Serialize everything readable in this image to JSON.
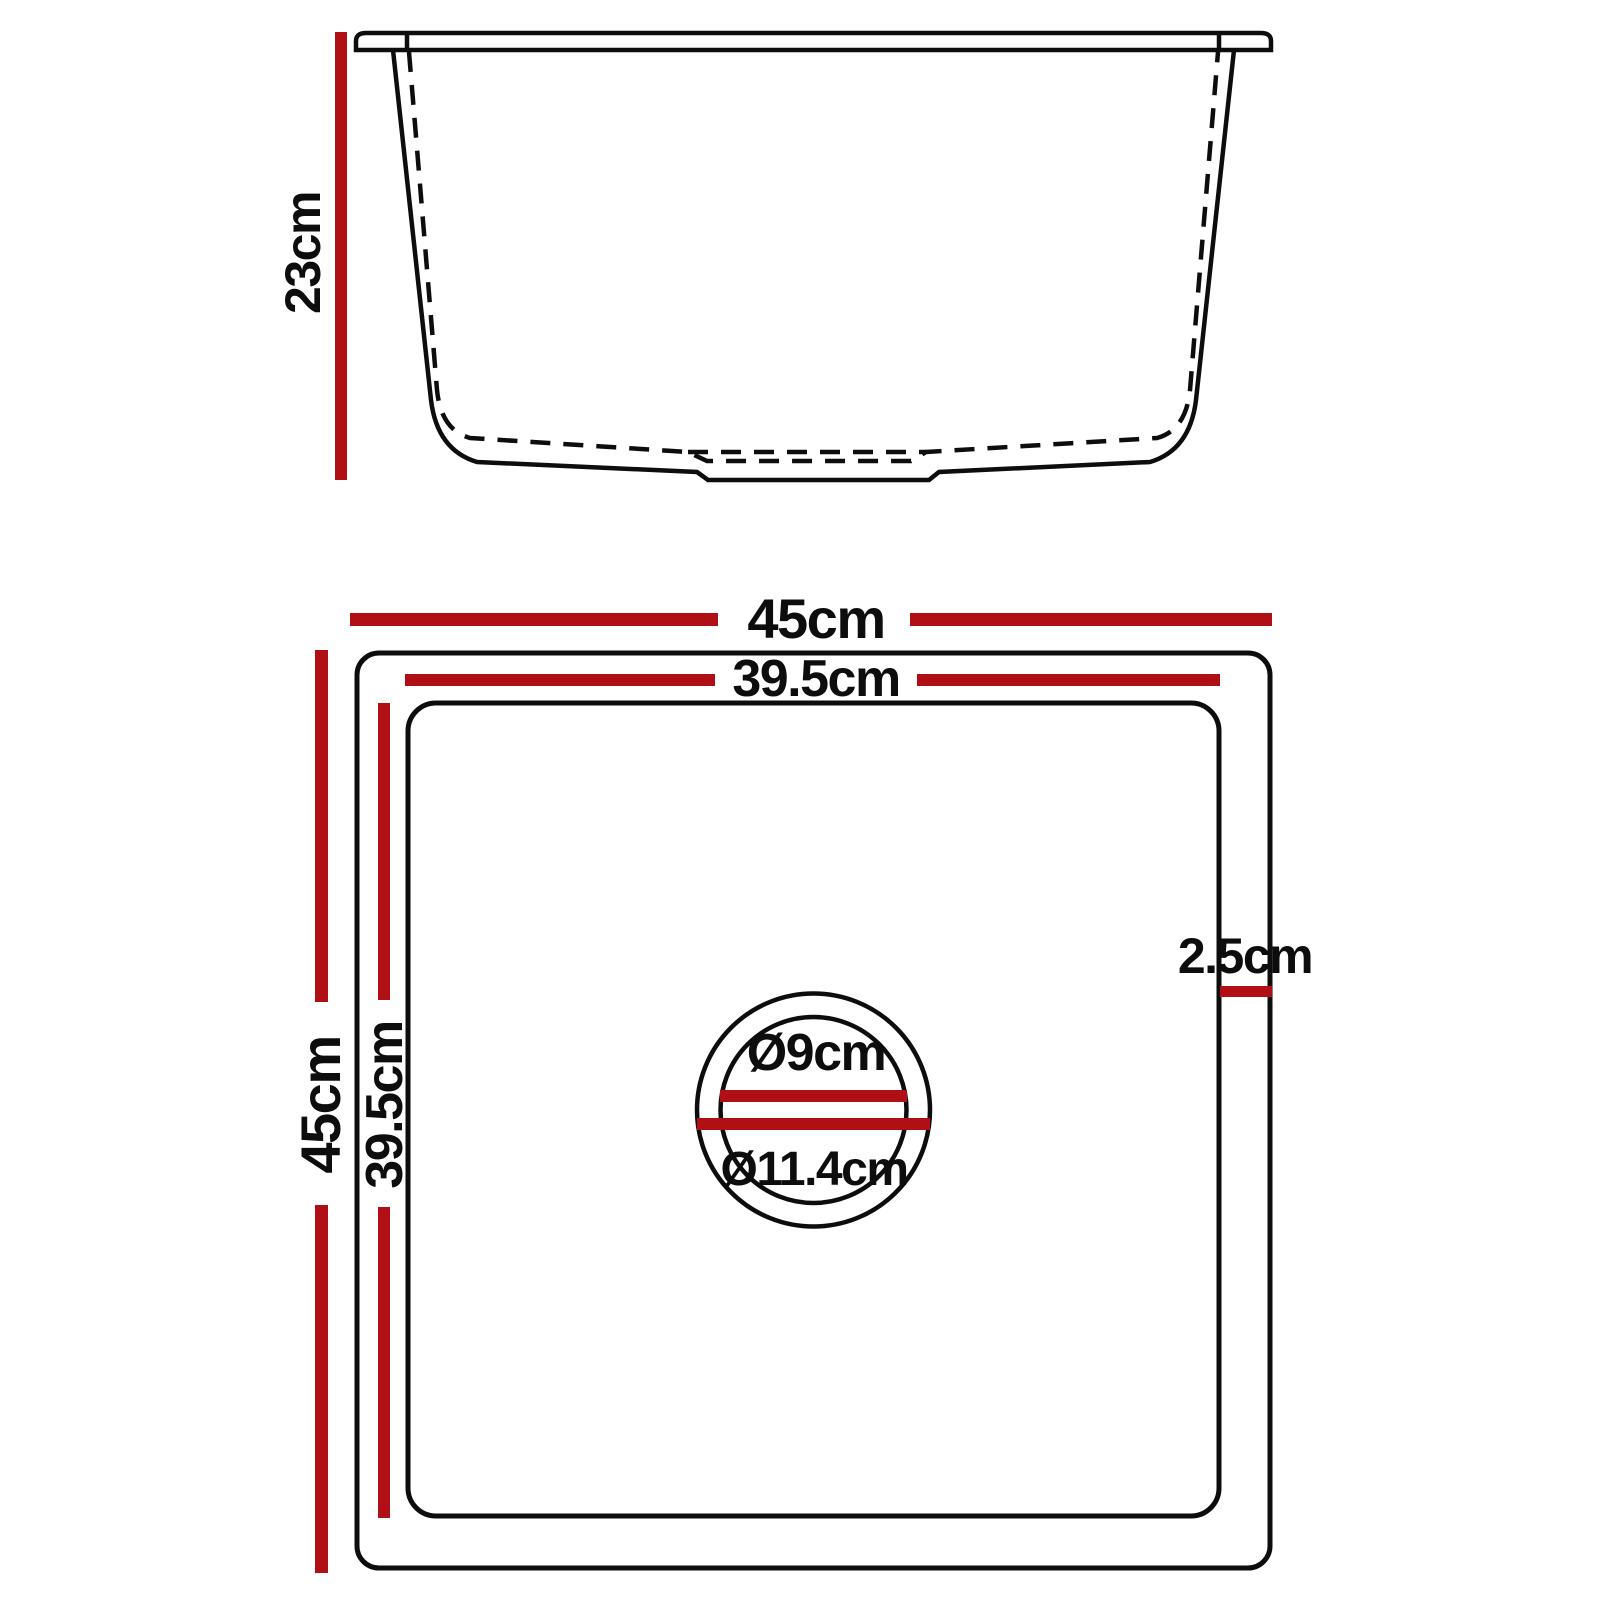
{
  "colors": {
    "dimension_red": "#b01015",
    "line_black": "#0d0d0d"
  },
  "side_view": {
    "depth_label": "23cm"
  },
  "top_view": {
    "outer_width_label": "45cm",
    "inner_width_label": "39.5cm",
    "outer_height_label": "45cm",
    "inner_height_label": "39.5cm",
    "rim_width_label": "2.5cm",
    "drain_inner_diameter_label": "Ø9cm",
    "drain_outer_diameter_label": "Ø11.4cm"
  }
}
